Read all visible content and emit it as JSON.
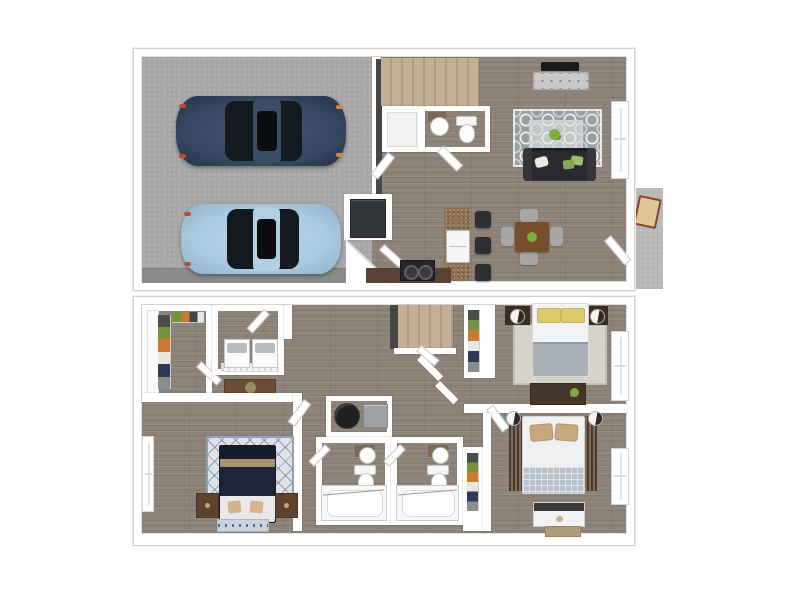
{
  "page": {
    "background": "#ffffff"
  },
  "floorplan": {
    "style": "3d-rendered top-down two-story apartment floor plan",
    "floors": [
      {
        "id": "first-floor",
        "label": "First floor: two-car garage, staircase, pantry, half bath, kitchen with island, dining area, living room, rear patio",
        "rooms": [
          "garage",
          "stairs",
          "pantry",
          "half-bath",
          "kitchen",
          "dining-area",
          "living-room",
          "patio"
        ],
        "objects": {
          "cars": 2,
          "bar_stools": 3,
          "dining_chairs": 4,
          "sofas": 1,
          "tvs": 1,
          "refrigerators": 1,
          "ranges": 1,
          "sinks": 2,
          "toilets": 1,
          "patio_chairs": 1
        }
      },
      {
        "id": "second-floor",
        "label": "Second floor: primary bedroom, two bedrooms, two full bathrooms, walk-in closet, laundry closet, mechanical closet, staircase",
        "rooms": [
          "walk-in-closet",
          "laundry",
          "hallway",
          "stairs",
          "primary-bedroom",
          "bedroom-2",
          "bedroom-3",
          "bathroom-1",
          "bathroom-2",
          "mechanical-closet",
          "closet-2",
          "closet-3"
        ],
        "objects": {
          "beds": 3,
          "bathtubs": 2,
          "toilets": 2,
          "sinks": 2,
          "washers": 1,
          "dryers": 1,
          "water_heaters": 1,
          "furnaces": 1,
          "dressers": 4,
          "nightstands": 4
        }
      }
    ],
    "colors": {
      "wall": "#ffffff",
      "wood_floor": "#8d8379",
      "garage_floor": "#a6a6a6",
      "driveway": "#8b8b8b",
      "stairs_carpet": "#c7ae96",
      "navy_car": "#35465f",
      "light_blue_car": "#a9c9df",
      "sofa_dark": "#2a2a2e",
      "living_rug": "#9aa0a2",
      "island_granite": "#8d7254",
      "lower_counter": "#5a4334",
      "dining_table_wood": "#784e2d",
      "chair_gray": "#a6a6a8",
      "refrigerator": "#33363a",
      "stove_black": "#26262a",
      "master_bed_navy": "#1d2638",
      "master_rug": "#dfe2e6",
      "nightstand_brown": "#5d432f",
      "dresser_dark": "#46352a",
      "duvet_gray": "#a9b0b6",
      "pillow_yellow": "#ddca6e",
      "pillow_tan": "#c8a87e",
      "quilt_blue": "#b9c2cc",
      "curtain_brown": "#4c3a2d",
      "water_heater": "#1f2022",
      "furnace": "#9fa2a4",
      "backsplash_tile": "#7d6a52",
      "plant_green": "#7fae3f",
      "patio_concrete": "#b7b7b7",
      "patio_chair_seat": "#dcc795",
      "patio_chair_frame": "#8d4030"
    }
  }
}
